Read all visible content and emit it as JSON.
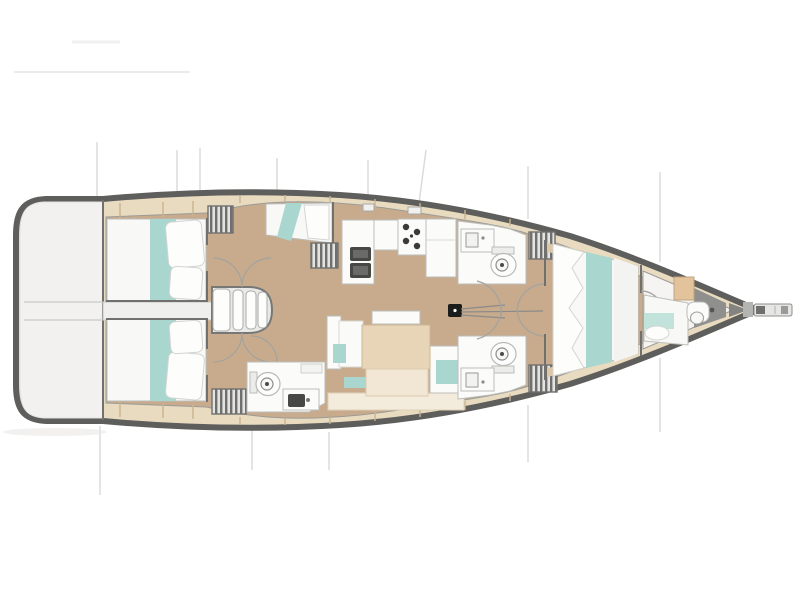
{
  "diagram": {
    "type": "yacht-interior-floor-plan",
    "orientation": "bow-right",
    "rooms": [
      {
        "id": "swim-platform",
        "furniture": [
          "transom-walkway"
        ]
      },
      {
        "id": "aft-cabin-port",
        "furniture": [
          "double-berth",
          "bed-runner",
          "pillows",
          "hanging-locker"
        ]
      },
      {
        "id": "aft-cabin-starboard",
        "furniture": [
          "double-berth",
          "bed-runner",
          "pillows",
          "hanging-locker"
        ]
      },
      {
        "id": "companionway",
        "furniture": [
          "steps"
        ]
      },
      {
        "id": "aft-head-starboard",
        "furniture": [
          "toilet",
          "washbasin"
        ]
      },
      {
        "id": "single-berth-port",
        "furniture": [
          "berth-cushion",
          "pillow"
        ]
      },
      {
        "id": "galley",
        "furniture": [
          "double-sink",
          "stove-four-burner",
          "refrigerator-counter",
          "louvered-locker"
        ]
      },
      {
        "id": "saloon",
        "furniture": [
          "u-settee",
          "teal-cushions",
          "dining-table",
          "bench"
        ]
      },
      {
        "id": "head-forward-port",
        "furniture": [
          "toilet",
          "washbasin",
          "hanging-locker"
        ]
      },
      {
        "id": "head-forward-starboard",
        "furniture": [
          "toilet",
          "washbasin",
          "hanging-locker"
        ]
      },
      {
        "id": "corridor",
        "furniture": [
          "door-swing-arcs",
          "mast-foot",
          "traveler-lines"
        ]
      },
      {
        "id": "forward-cabin",
        "furniture": [
          "double-berth",
          "bed-runner",
          "pillows",
          "side-shelves"
        ]
      },
      {
        "id": "forepeak-cabin",
        "furniture": [
          "berth",
          "cabinet",
          "washstand"
        ]
      },
      {
        "id": "bowsprit",
        "furniture": [
          "anchor-roller"
        ]
      }
    ],
    "annotations": [
      "section-lines",
      "deck-seams",
      "door-swing-arcs"
    ]
  },
  "colors": {
    "background": "#ffffff",
    "hull_outline": "#5e5e5c",
    "stern_platform": "#f2f1ef",
    "deck": "#e9dbc0",
    "deck_seam": "#c9b38e",
    "floor": "#c8ab8d",
    "furniture_white": "#fbfbfa",
    "furniture_border": "#bdbdb9",
    "bedding_white": "#f8f8f6",
    "pillow": "#fdfdfc",
    "pillow_border": "#d4d4d1",
    "accent_teal": "#a9d6cf",
    "accent_teal_soft": "#c2e2dc",
    "table_top": "#e8d4b6",
    "table_light": "#f2e6d4",
    "appliance_dark": "#474745",
    "wall_line": "#70706e",
    "locker_dark": "#6f6f6d",
    "locker_light": "#e3e3e1",
    "walkway": "#efefed",
    "bench_cream": "#f3ecdd",
    "wood_cabinet": "#e2c39b",
    "gray_wedge": "#8f8f8d",
    "mast_black": "#1c1c1a",
    "arc_line": "#a2a29f",
    "section_line": "#d9d9d7"
  }
}
